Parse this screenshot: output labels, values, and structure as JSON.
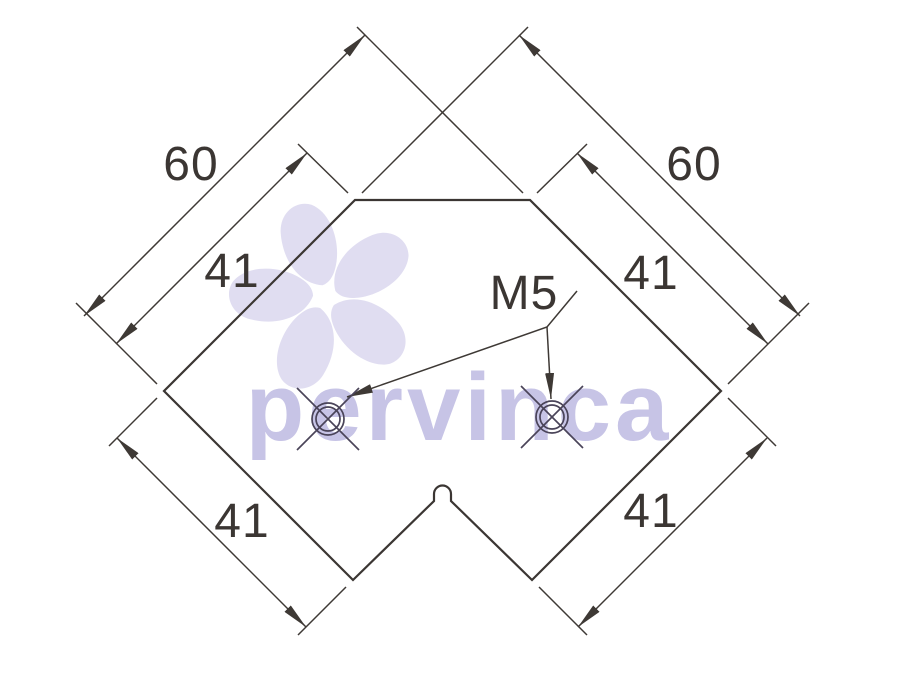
{
  "drawing": {
    "type": "technical-drawing",
    "subject": "corner bracket profile with two threaded holes",
    "line_color": "#3b3633",
    "hole_line_color": "#4a4459",
    "background_color": "#ffffff",
    "labels": {
      "dim_60_left": "60",
      "dim_60_right": "60",
      "dim_41_upper_left": "41",
      "dim_41_upper_right": "41",
      "dim_41_lower_left": "41",
      "dim_41_lower_right": "41",
      "thread_callout": "M5"
    }
  },
  "watermark": {
    "text": "pervinca",
    "text_color": "#c7c4e6",
    "flower_color": "#e0ddf1"
  }
}
